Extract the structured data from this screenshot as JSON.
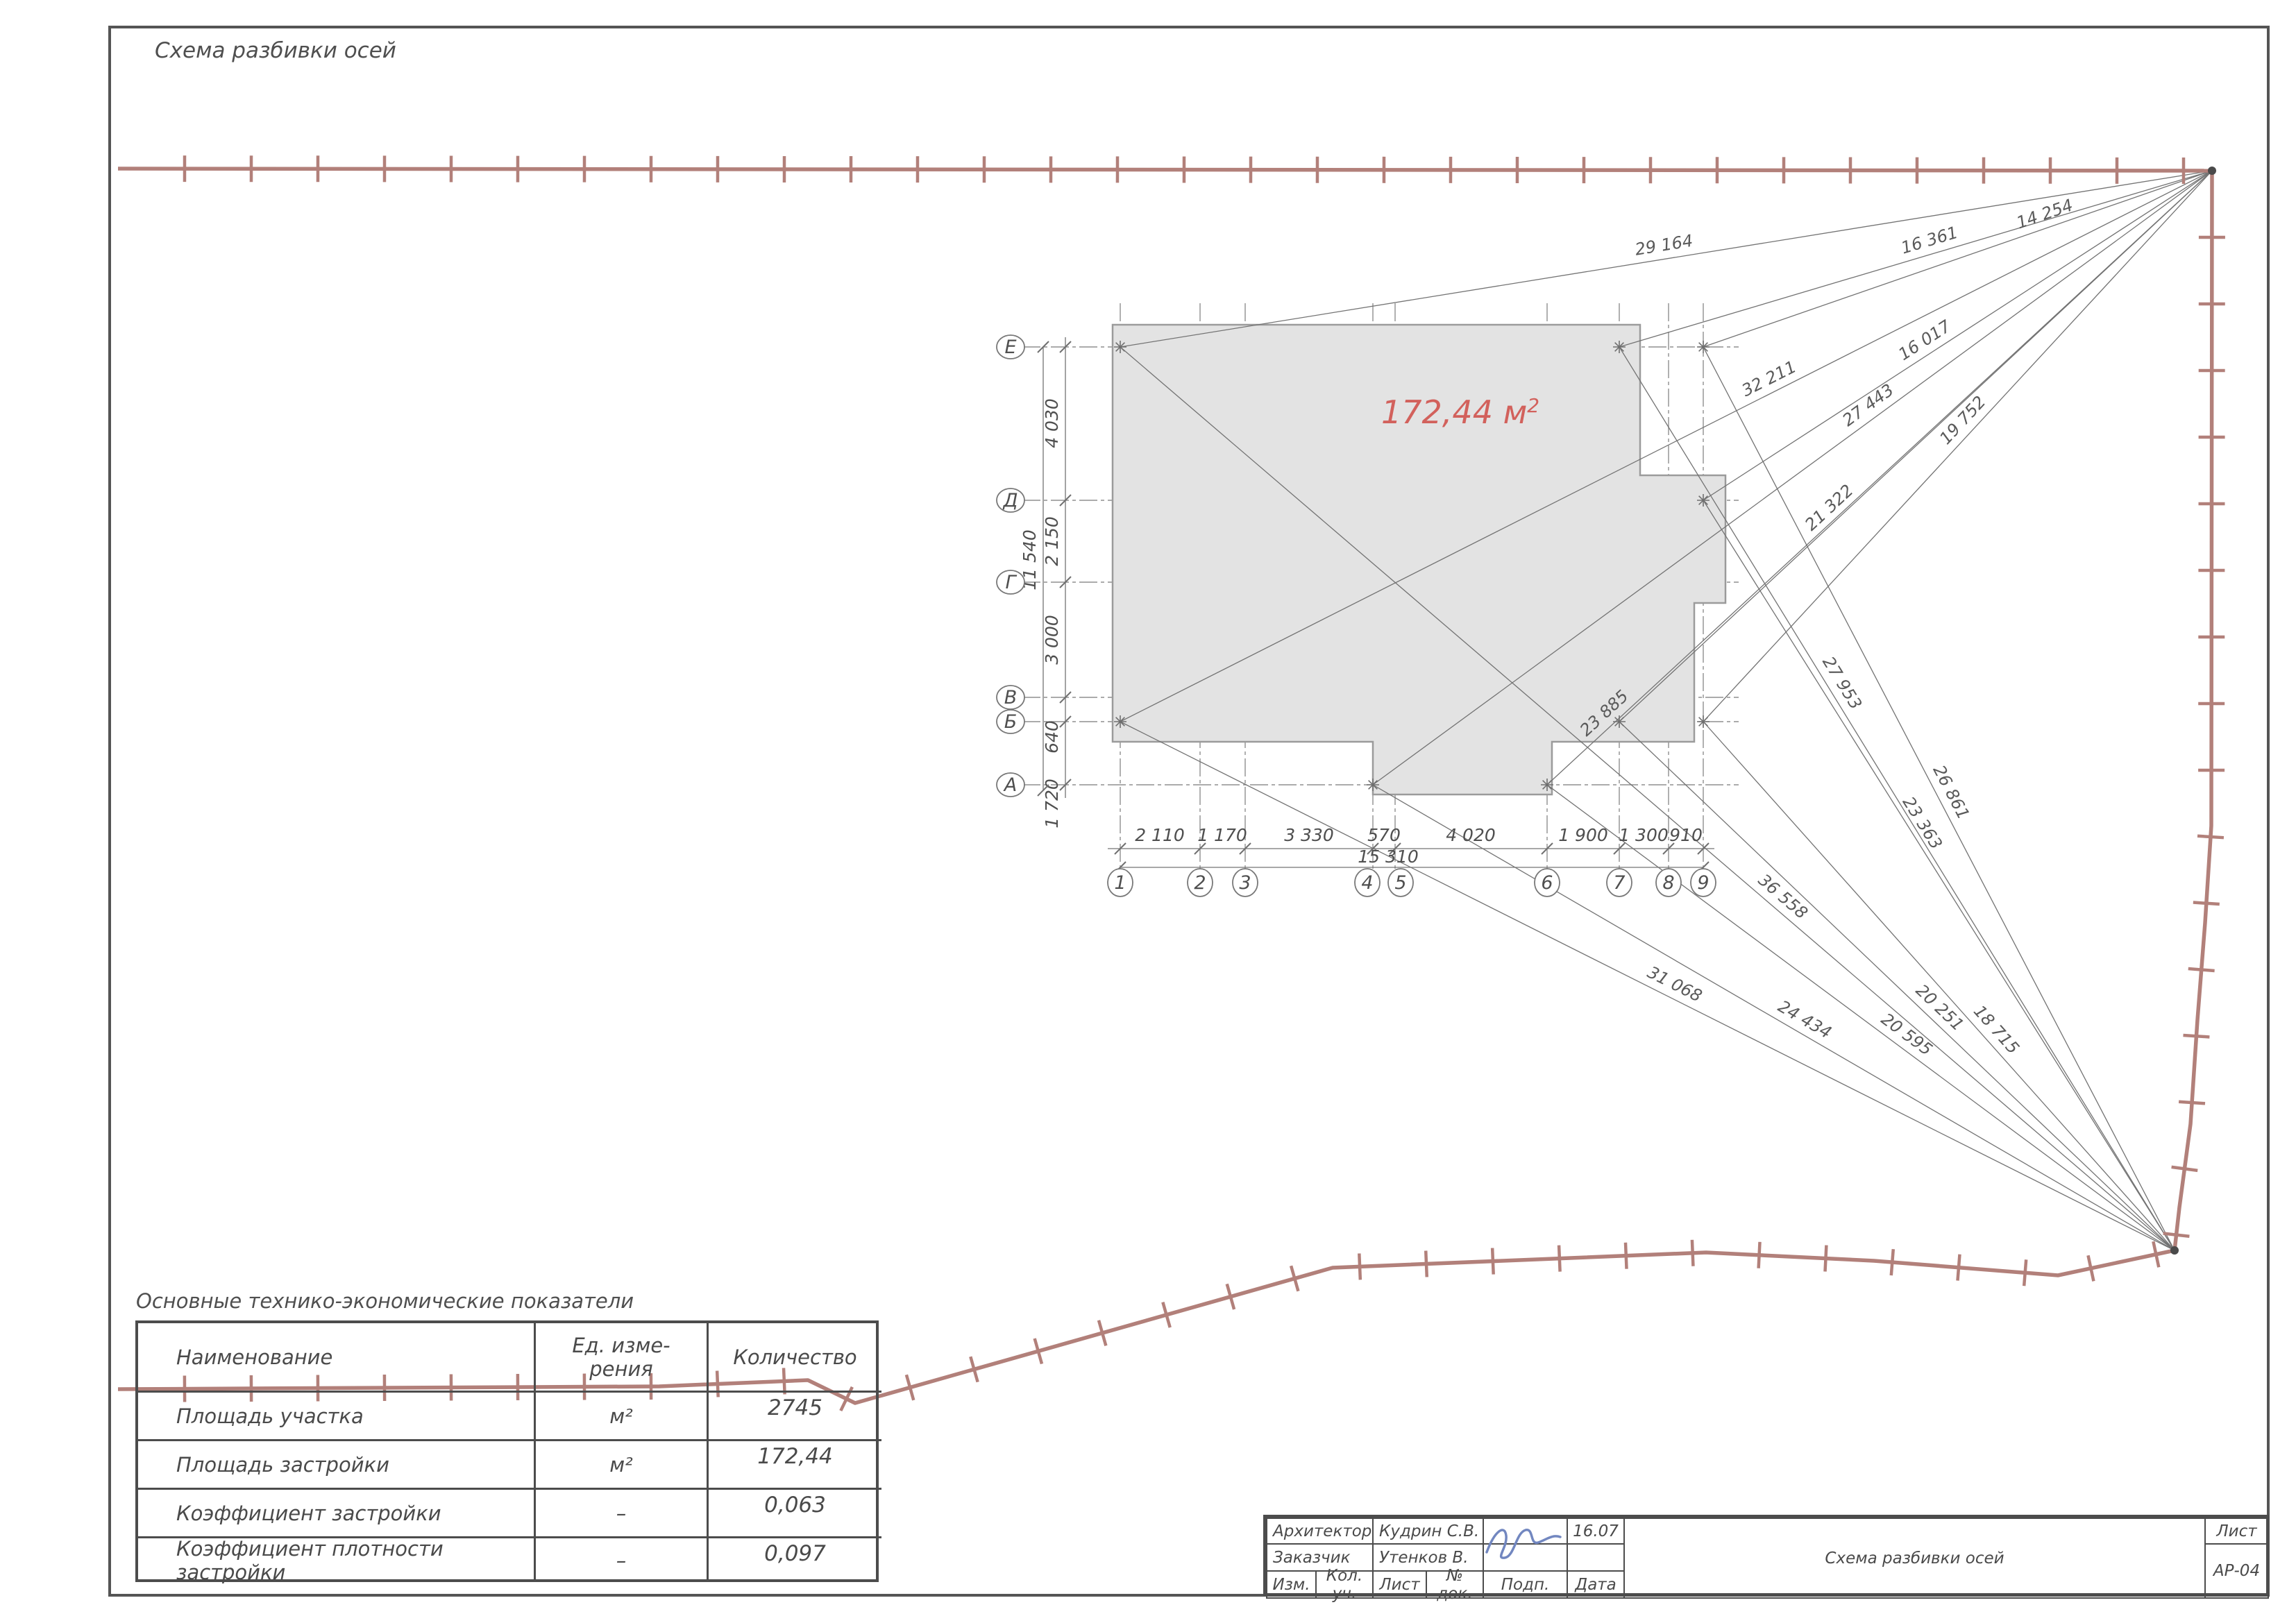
{
  "page": {
    "title": "Схема разбивки осей"
  },
  "plan": {
    "area_value": "172,44 м",
    "area_sup": "2",
    "axes_horizontal": [
      "1",
      "2",
      "3",
      "4",
      "5",
      "6",
      "7",
      "8",
      "9"
    ],
    "axes_vertical": [
      "Е",
      "Д",
      "Г",
      "В",
      "Б",
      "А"
    ],
    "dims_horizontal": [
      "2 110",
      "1 170",
      "3 330",
      "570",
      "4 020",
      "1 900",
      "1 300",
      "910"
    ],
    "dims_horizontal_total": "15 310",
    "dims_vertical": [
      "4 030",
      "2 150",
      "3 000",
      "640",
      "1 720"
    ],
    "dims_vertical_total": "11 540",
    "survey_tr": [
      "29 164",
      "16 361",
      "14 254",
      "16 017",
      "32 211",
      "21 322",
      "19 752",
      "27 443",
      "23 885"
    ],
    "survey_br": [
      "36 558",
      "27 953",
      "26 861",
      "23 363",
      "31 068",
      "20 251",
      "18 715",
      "24 434",
      "20 595"
    ]
  },
  "table": {
    "title": "Основные технико-экономические показатели",
    "header_name": "Наименование",
    "header_unit": [
      "Ед. изме-",
      "рения"
    ],
    "header_qty": "Количество",
    "rows": [
      [
        "Площадь участка",
        "м²",
        "2745"
      ],
      [
        "Площадь застройки",
        "м²",
        "172,44"
      ],
      [
        "Коэффициент застройки",
        "–",
        "0,063"
      ],
      [
        "Коэффициент плотности застройки",
        "–",
        "0,097"
      ]
    ]
  },
  "titleblock": {
    "rows": [
      {
        "role": "Архитектор",
        "name": "Кудрин С.В.",
        "date": "16.07"
      },
      {
        "role": "Заказчик",
        "name": "Утенков В.",
        "date": ""
      }
    ],
    "bottom_labels": [
      "Изм.",
      "Кол. уч.",
      "Лист",
      "№ док.",
      "Подп.",
      "Дата"
    ],
    "doc_title": "Схема разбивки осей",
    "sheet_label": "Лист",
    "sheet_number": "АР-04"
  },
  "colors": {
    "boundary": "#b2807a",
    "area_label": "#d2615c",
    "frame": "#555555",
    "thin_line": "#737373",
    "building_fill": "#e3e3e3",
    "building_stroke": "#9b9b9b"
  }
}
